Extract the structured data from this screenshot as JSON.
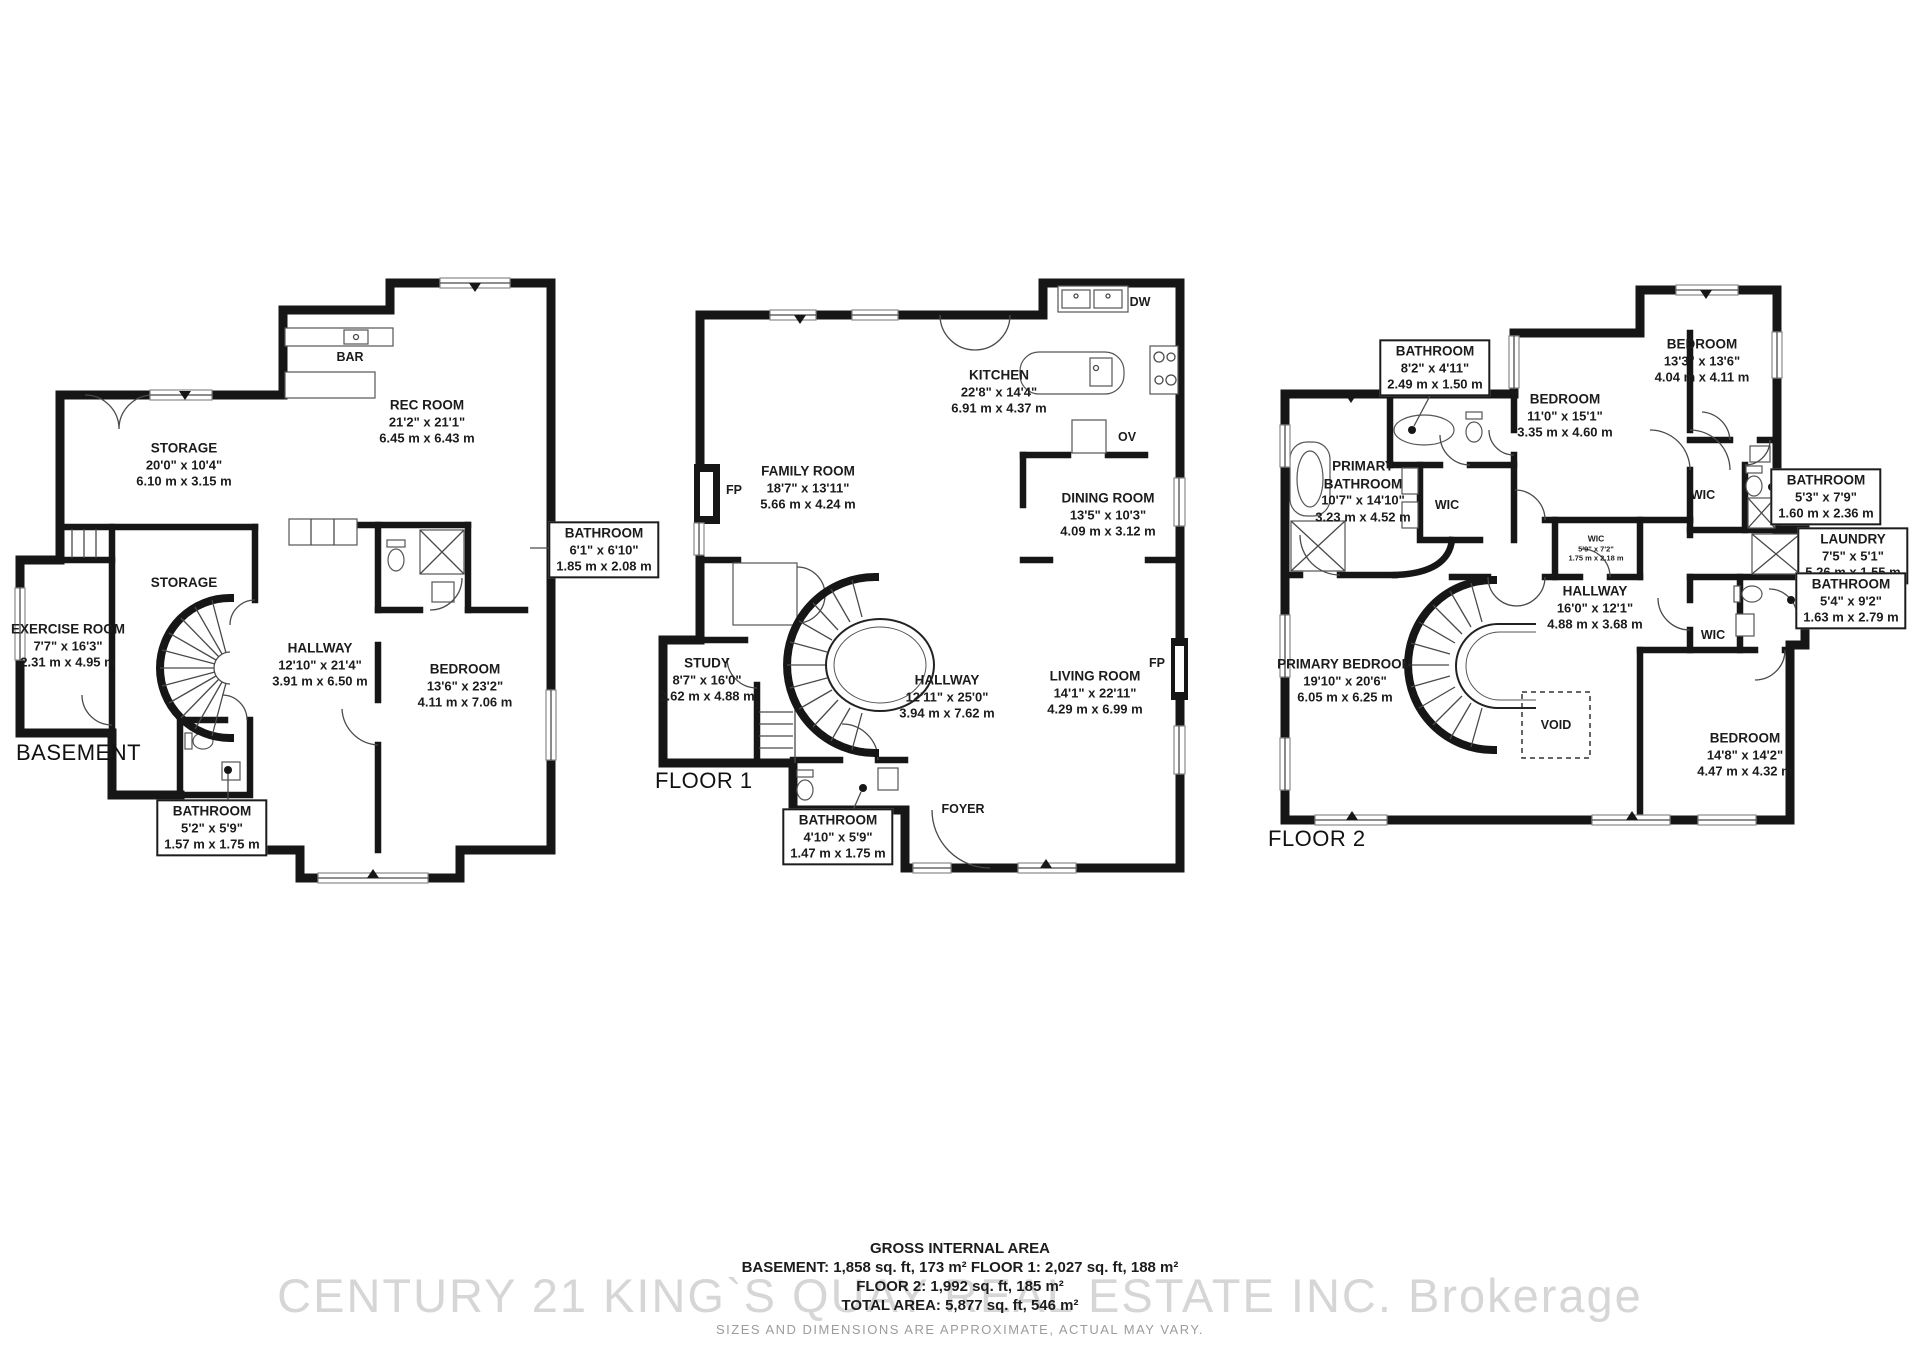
{
  "basement": {
    "tag": "BASEMENT",
    "bar": "BAR",
    "rec": {
      "n": "REC ROOM",
      "f": "21'2\" x 21'1\"",
      "m": "6.45 m x 6.43 m"
    },
    "storage1": {
      "n": "STORAGE",
      "f": "20'0\" x 10'4\"",
      "m": "6.10 m x 3.15 m"
    },
    "storage2": {
      "n": "STORAGE"
    },
    "exercise": {
      "n": "EXERCISE ROOM",
      "f": "7'7\" x 16'3\"",
      "m": "2.31 m x 4.95 m"
    },
    "hallway": {
      "n": "HALLWAY",
      "f": "12'10\" x 21'4\"",
      "m": "3.91 m x 6.50 m"
    },
    "bedroom": {
      "n": "BEDROOM",
      "f": "13'6\" x 23'2\"",
      "m": "4.11 m x 7.06 m"
    },
    "bath_right": {
      "n": "BATHROOM",
      "f": "6'1\" x 6'10\"",
      "m": "1.85 m x 2.08 m"
    },
    "bath_bottom": {
      "n": "BATHROOM",
      "f": "5'2\" x 5'9\"",
      "m": "1.57 m x 1.75 m"
    }
  },
  "floor1": {
    "tag": "FLOOR 1",
    "dw": "DW",
    "ov": "OV",
    "fp_left": "FP",
    "fp_right": "FP",
    "foyer": "FOYER",
    "kitchen": {
      "n": "KITCHEN",
      "f": "22'8\" x 14'4\"",
      "m": "6.91 m x 4.37 m"
    },
    "family": {
      "n": "FAMILY ROOM",
      "f": "18'7\" x 13'11\"",
      "m": "5.66 m x 4.24 m"
    },
    "dining": {
      "n": "DINING ROOM",
      "f": "13'5\" x 10'3\"",
      "m": "4.09 m x 3.12 m"
    },
    "study": {
      "n": "STUDY",
      "f": "8'7\" x 16'0\"",
      "m": "2.62 m x 4.88 m"
    },
    "hallway": {
      "n": "HALLWAY",
      "f": "12'11\" x 25'0\"",
      "m": "3.94 m x 7.62 m"
    },
    "living": {
      "n": "LIVING ROOM",
      "f": "14'1\" x 22'11\"",
      "m": "4.29 m x 6.99 m"
    },
    "bath": {
      "n": "BATHROOM",
      "f": "4'10\" x 5'9\"",
      "m": "1.47 m x 1.75 m"
    }
  },
  "floor2": {
    "tag": "FLOOR 2",
    "wic_center": "WIC",
    "wic_right": "WIC",
    "wic_bottom": "WIC",
    "void": "VOID",
    "bath_top": {
      "n": "BATHROOM",
      "f": "8'2\" x 4'11\"",
      "m": "2.49 m x 1.50 m"
    },
    "bed11": {
      "n": "BEDROOM",
      "f": "11'0\" x 15'1\"",
      "m": "3.35 m x 4.60 m"
    },
    "bed13": {
      "n": "BEDROOM",
      "f": "13'3\" x 13'6\"",
      "m": "4.04 m x 4.11 m"
    },
    "pbath": {
      "n": "PRIMARY BATHROOM",
      "f": "10'7\" x 14'10\"",
      "m": "3.23 m x 4.52 m"
    },
    "wic_dims": {
      "n": "WIC",
      "f": "5'9\" x 7'2\"",
      "m": "1.75 m x 2.18 m"
    },
    "bath53": {
      "n": "BATHROOM",
      "f": "5'3\" x 7'9\"",
      "m": "1.60 m x 2.36 m"
    },
    "laundry": {
      "n": "LAUNDRY",
      "f": "7'5\" x 5'1\"",
      "m": "5.26 m x 1.55 m"
    },
    "bath54": {
      "n": "BATHROOM",
      "f": "5'4\" x 9'2\"",
      "m": "1.63 m x 2.79 m"
    },
    "hallway": {
      "n": "HALLWAY",
      "f": "16'0\" x 12'1\"",
      "m": "4.88 m x 3.68 m"
    },
    "pbed": {
      "n": "PRIMARY BEDROOM",
      "f": "19'10\" x 20'6\"",
      "m": "6.05 m x 6.25 m"
    },
    "bed14": {
      "n": "BEDROOM",
      "f": "14'8\" x 14'2\"",
      "m": "4.47 m x 4.32 m"
    }
  },
  "footer": {
    "title": "GROSS INTERNAL AREA",
    "line1": "BASEMENT: 1,858 sq. ft, 173 m²  FLOOR 1: 2,027 sq. ft, 188 m²",
    "line2": "FLOOR 2: 1,992 sq. ft, 185 m²",
    "line3": "TOTAL AREA: 5,877 sq. ft, 546 m²",
    "disclaimer": "SIZES AND DIMENSIONS ARE APPROXIMATE, ACTUAL MAY VARY.",
    "watermark": "CENTURY 21 KING`S QUAY REAL ESTATE INC.  Brokerage"
  }
}
